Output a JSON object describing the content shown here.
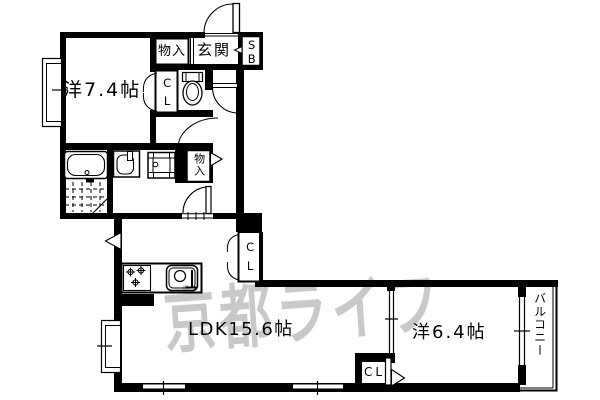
{
  "labels": {
    "bedroom1": "洋7.4帖",
    "entrance": "玄関",
    "storage_top": "物入",
    "shoe_box": "SB",
    "closet_hall": "CL",
    "storage_hall": "物入",
    "ldk": "LDK15.6帖",
    "closet_ldk": "CL",
    "bedroom2": "洋6.4帖",
    "closet_bedroom": "CL",
    "balcony": "バルコニー"
  },
  "watermark": {
    "text": "京都ライフ",
    "color": "#c9c9c9"
  },
  "colors": {
    "line": "#000000",
    "background": "#ffffff"
  }
}
